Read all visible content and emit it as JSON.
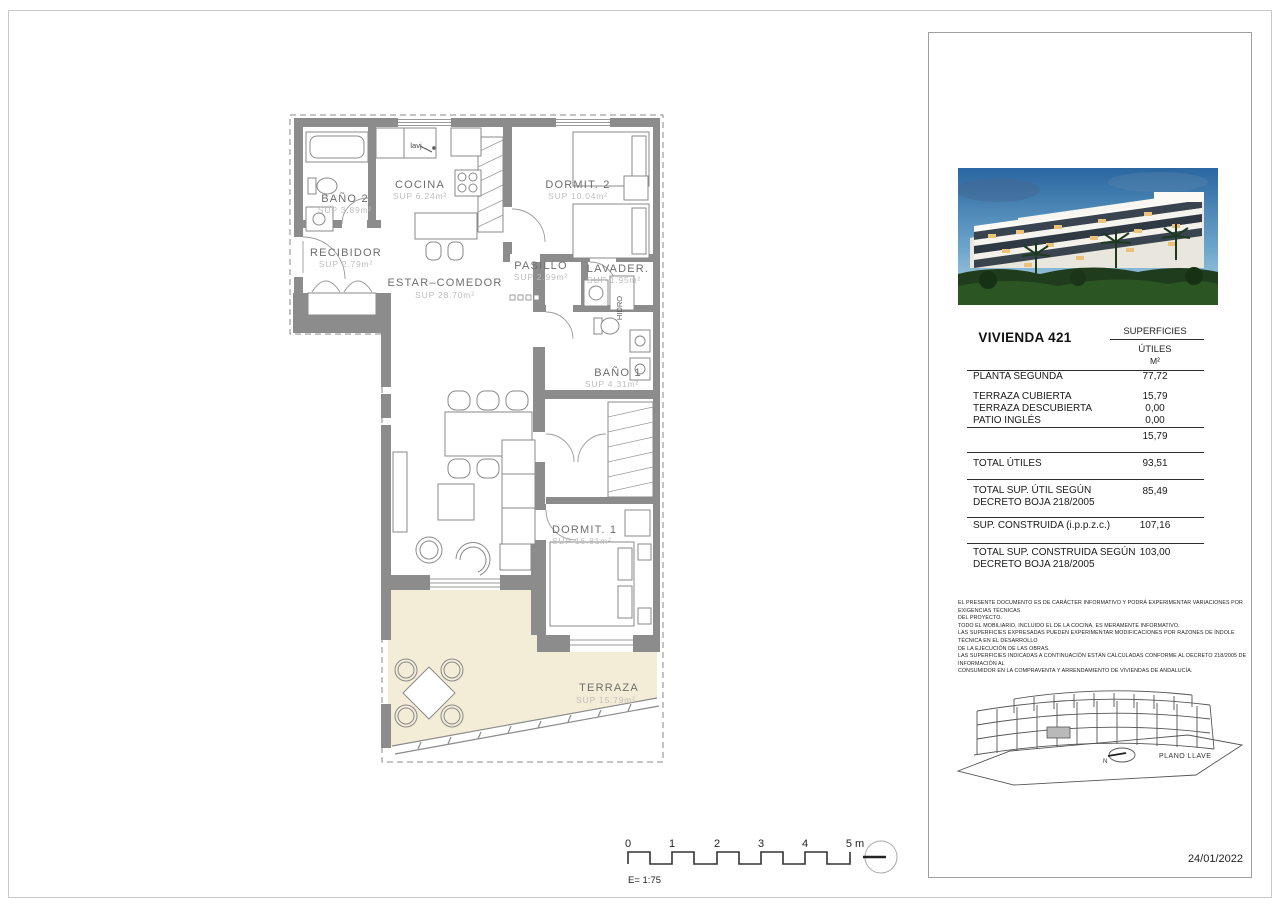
{
  "page": {
    "frame_color": "#c9c9c9"
  },
  "plan": {
    "wall_color": "#8c8c8c",
    "terrace_fill": "#f3ecd7",
    "annotations": {
      "lavj": "lavj",
      "hidro": "HIDRO"
    },
    "rooms": [
      {
        "name": "BAÑO 2",
        "sup": "SUP 3.89m²"
      },
      {
        "name": "COCINA",
        "sup": "SUP 6.24m²"
      },
      {
        "name": "DORMIT.  2",
        "sup": "SUP 10.04m²"
      },
      {
        "name": "RECIBIDOR",
        "sup": "SUP 2.79m²"
      },
      {
        "name": "ESTAR–COMEDOR",
        "sup": "SUP 28.70m²"
      },
      {
        "name": "PASILLO",
        "sup": "SUP 2.99m²"
      },
      {
        "name": "LAVADER.",
        "sup": "SUP 1.95m²"
      },
      {
        "name": "BAÑO 1",
        "sup": "SUP 4.31m²"
      },
      {
        "name": "DORMIT.  1",
        "sup": "SUP 16.81m²"
      },
      {
        "name": "TERRAZA",
        "sup": "SUP 15.79m²"
      }
    ]
  },
  "scalebar": {
    "labels": [
      "0",
      "1",
      "2",
      "3",
      "4",
      "5 m"
    ],
    "scale_text": "E= 1:75"
  },
  "panel": {
    "title": "VIVIENDA 421",
    "header": {
      "col": "SUPERFICIES",
      "sub": "ÚTILES",
      "unit": "M²"
    },
    "rows": [
      {
        "label": "PLANTA SEGUNDA",
        "value": "77,72"
      },
      {
        "label": "TERRAZA CUBIERTA",
        "value": "15,79"
      },
      {
        "label": "TERRAZA DESCUBIERTA",
        "value": "0,00"
      },
      {
        "label": "PATIO INGLÉS",
        "value": "0,00"
      },
      {
        "label": "",
        "value": "15,79"
      },
      {
        "label": "TOTAL ÚTILES",
        "value": "93,51"
      },
      {
        "label": "TOTAL SUP. ÚTIL SEGÚN DECRETO BOJA 218/2005",
        "value": "85,49"
      },
      {
        "label": "SUP. CONSTRUIDA (i.p.p.z.c.)",
        "value": "107,16"
      },
      {
        "label": "TOTAL SUP. CONSTRUIDA SEGÚN DECRETO BOJA 218/2005",
        "value": "103,00"
      }
    ],
    "disclaimer": [
      "EL PRESENTE DOCUMENTO ES DE CARÁCTER INFORMATIVO Y PODRÁ EXPERIMENTAR VARIACIONES POR EXIGENCIAS TÉCNICAS",
      "DEL PROYECTO.",
      "TODO EL MOBILIARIO, INCLUIDO EL DE LA COCINA, ES MERAMENTE INFORMATIVO.",
      "LAS SUPERFICIES EXPRESADAS PUEDEN EXPERIMENTAR MODIFICACIONES POR RAZONES DE ÍNDOLE TÉCNICA EN EL DESARROLLO",
      "DE LA EJECUCIÓN DE LAS OBRAS.",
      "LAS SUPERFICIES INDICADAS A CONTINUACIÓN ESTÁN CALCULADAS CONFORME AL DECRETO 218/2005 DE INFORMACIÓN AL",
      "CONSUMIDOR EN LA COMPRAVENTA Y ARRENDAMIENTO DE VIVIENDAS DE ANDALUCÍA."
    ],
    "keyplan": {
      "label": "PLANO LLAVE",
      "north": "N"
    },
    "date": "24/01/2022"
  }
}
